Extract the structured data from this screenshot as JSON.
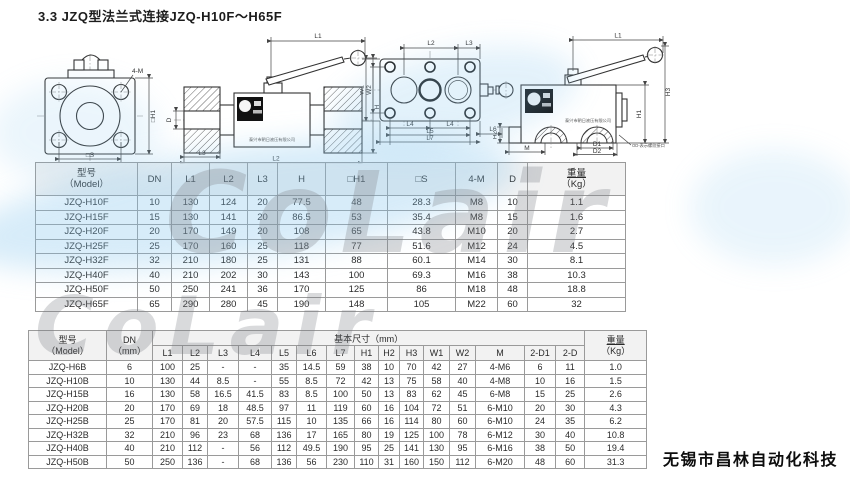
{
  "page": {
    "title": "3.3 JZQ型法兰式连接JZQ-H10F～H65F",
    "company": "无锡市昌林自动化科技",
    "watermark": "CoLair"
  },
  "drawings": {
    "front": {
      "bolt": "4-M",
      "h1": "□H1",
      "s": "□S"
    },
    "side": {
      "l1": "L1",
      "h": "H",
      "d": "D",
      "l3": "L3",
      "l2": "L2",
      "plate": "泰兴市朝日液压有限公司"
    },
    "plan": {
      "l2": "L2",
      "l3": "L3",
      "w1": "W1",
      "w2": "W2",
      "l4a": "L4",
      "l4b": "L4",
      "l5": "L5",
      "l7": "L7",
      "l6": "L6"
    },
    "block": {
      "l1": "L1",
      "h1": "H1",
      "h2": "H2",
      "h3": "H3",
      "m": "M",
      "d1": "D1",
      "d2": "D2",
      "note": "OD-表示螺纹接口",
      "plate": "泰兴市朝日液压有限公司"
    }
  },
  "table1": {
    "model_cn": "型号",
    "model_en": "（Model）",
    "cols": [
      "DN",
      "L1",
      "L2",
      "L3",
      "H",
      "□H1",
      "□S",
      "4-M",
      "D"
    ],
    "weight_cn": "重量",
    "weight_en": "（Kg）",
    "rows": [
      [
        "JZQ-H10F",
        "10",
        "130",
        "124",
        "20",
        "77.5",
        "48",
        "28.3",
        "M8",
        "10",
        "1.1"
      ],
      [
        "JZQ-H15F",
        "15",
        "130",
        "141",
        "20",
        "86.5",
        "53",
        "35.4",
        "M8",
        "15",
        "1.6"
      ],
      [
        "JZQ-H20F",
        "20",
        "170",
        "149",
        "20",
        "108",
        "65",
        "43.8",
        "M10",
        "20",
        "2.7"
      ],
      [
        "JZQ-H25F",
        "25",
        "170",
        "160",
        "25",
        "118",
        "77",
        "51.6",
        "M12",
        "24",
        "4.5"
      ],
      [
        "JZQ-H32F",
        "32",
        "210",
        "180",
        "25",
        "131",
        "88",
        "60.1",
        "M14",
        "30",
        "8.1"
      ],
      [
        "JZQ-H40F",
        "40",
        "210",
        "202",
        "30",
        "143",
        "100",
        "69.3",
        "M16",
        "38",
        "10.3"
      ],
      [
        "JZQ-H50F",
        "50",
        "250",
        "241",
        "36",
        "170",
        "125",
        "86",
        "M18",
        "48",
        "18.8"
      ],
      [
        "JZQ-H65F",
        "65",
        "290",
        "280",
        "45",
        "190",
        "148",
        "105",
        "M22",
        "60",
        "32"
      ]
    ]
  },
  "table2": {
    "model_cn": "型号",
    "model_en": "（Model）",
    "dn_cn": "DN",
    "dn_en": "（mm）",
    "group": "基本尺寸（mm）",
    "cols": [
      "L1",
      "L2",
      "L3",
      "L4",
      "L5",
      "L6",
      "L7",
      "H1",
      "H2",
      "H3",
      "W1",
      "W2",
      "M",
      "2-D1",
      "2-D"
    ],
    "weight_cn": "重量",
    "weight_en": "（Kg）",
    "rows": [
      [
        "JZQ-H6B",
        "6",
        "100",
        "25",
        "-",
        "-",
        "35",
        "14.5",
        "59",
        "38",
        "10",
        "70",
        "42",
        "27",
        "4-M6",
        "6",
        "11",
        "1.0"
      ],
      [
        "JZQ-H10B",
        "10",
        "130",
        "44",
        "8.5",
        "-",
        "55",
        "8.5",
        "72",
        "42",
        "13",
        "75",
        "58",
        "40",
        "4-M8",
        "10",
        "16",
        "1.5"
      ],
      [
        "JZQ-H15B",
        "16",
        "130",
        "58",
        "16.5",
        "41.5",
        "83",
        "8.5",
        "100",
        "50",
        "13",
        "83",
        "62",
        "45",
        "6-M8",
        "15",
        "25",
        "2.6"
      ],
      [
        "JZQ-H20B",
        "20",
        "170",
        "69",
        "18",
        "48.5",
        "97",
        "11",
        "119",
        "60",
        "16",
        "104",
        "72",
        "51",
        "6-M10",
        "20",
        "30",
        "4.3"
      ],
      [
        "JZQ-H25B",
        "25",
        "170",
        "81",
        "20",
        "57.5",
        "115",
        "10",
        "135",
        "66",
        "16",
        "114",
        "80",
        "60",
        "6-M10",
        "24",
        "35",
        "6.2"
      ],
      [
        "JZQ-H32B",
        "32",
        "210",
        "96",
        "23",
        "68",
        "136",
        "17",
        "165",
        "80",
        "19",
        "125",
        "100",
        "78",
        "6-M12",
        "30",
        "40",
        "10.8"
      ],
      [
        "JZQ-H40B",
        "40",
        "210",
        "112",
        "-",
        "56",
        "112",
        "49.5",
        "190",
        "95",
        "25",
        "141",
        "130",
        "95",
        "6-M16",
        "38",
        "50",
        "19.4"
      ],
      [
        "JZQ-H50B",
        "50",
        "250",
        "136",
        "-",
        "68",
        "136",
        "56",
        "230",
        "110",
        "31",
        "160",
        "150",
        "112",
        "6-M20",
        "48",
        "60",
        "31.3"
      ]
    ]
  }
}
